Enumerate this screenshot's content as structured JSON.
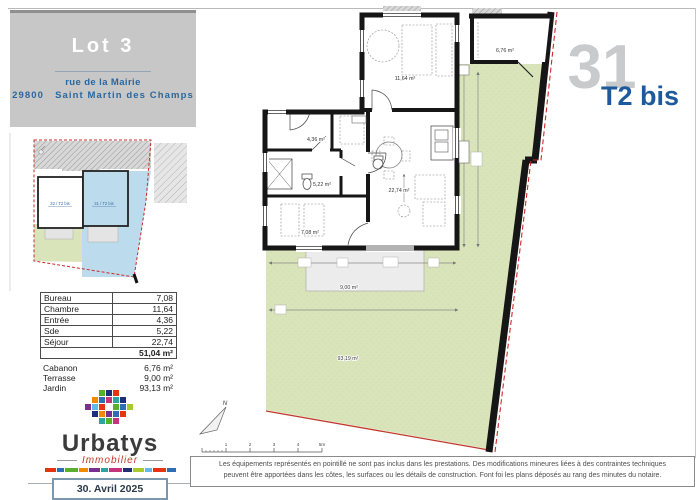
{
  "header": {
    "lot_title": "Lot 3",
    "street": "rue de la Mairie",
    "postal_code": "29800",
    "city": "Saint Martin des Champs"
  },
  "unit_badge": {
    "number": "31",
    "type": "T2 bis"
  },
  "site_plan": {
    "left_unit_label": "32 / T2 bis",
    "right_unit_label": "31 / T2 bis"
  },
  "areas": {
    "rows": [
      {
        "label": "Bureau",
        "value": "7,08"
      },
      {
        "label": "Chambre",
        "value": "11,64"
      },
      {
        "label": "Entrée",
        "value": "4,36"
      },
      {
        "label": "Sde",
        "value": "5,22"
      },
      {
        "label": "Séjour",
        "value": "22,74"
      }
    ],
    "total": "51,04 m²",
    "annex": [
      {
        "label": "Cabanon",
        "value": "6,76 m²"
      },
      {
        "label": "Terrasse",
        "value": "9,00 m²"
      },
      {
        "label": "Jardin",
        "value": "93,13 m²"
      }
    ]
  },
  "logo": {
    "name": "Urbatys",
    "subtitle": "Immobilier",
    "date": "30. Avril 2025",
    "mosaic": [
      {
        "x": 14,
        "y": 0,
        "c": "#5aaf2b"
      },
      {
        "x": 21,
        "y": 0,
        "c": "#1d2f7b"
      },
      {
        "x": 28,
        "y": 0,
        "c": "#e63312"
      },
      {
        "x": 7,
        "y": 7,
        "c": "#f18a00"
      },
      {
        "x": 14,
        "y": 7,
        "c": "#2f6db4"
      },
      {
        "x": 21,
        "y": 7,
        "c": "#c5357e"
      },
      {
        "x": 28,
        "y": 7,
        "c": "#2aa5a0"
      },
      {
        "x": 35,
        "y": 7,
        "c": "#1d2f7b"
      },
      {
        "x": 0,
        "y": 14,
        "c": "#7a2e8e"
      },
      {
        "x": 7,
        "y": 14,
        "c": "#64b9e4"
      },
      {
        "x": 14,
        "y": 14,
        "c": "#e63312"
      },
      {
        "x": 28,
        "y": 14,
        "c": "#5aaf2b"
      },
      {
        "x": 35,
        "y": 14,
        "c": "#2f6db4"
      },
      {
        "x": 42,
        "y": 14,
        "c": "#a8c92d"
      },
      {
        "x": 7,
        "y": 21,
        "c": "#1d2f7b"
      },
      {
        "x": 14,
        "y": 21,
        "c": "#f18a00"
      },
      {
        "x": 21,
        "y": 21,
        "c": "#7a2e8e"
      },
      {
        "x": 28,
        "y": 21,
        "c": "#2f6db4"
      },
      {
        "x": 35,
        "y": 21,
        "c": "#e63312"
      },
      {
        "x": 14,
        "y": 28,
        "c": "#2aa5a0"
      },
      {
        "x": 21,
        "y": 28,
        "c": "#5aaf2b"
      },
      {
        "x": 28,
        "y": 28,
        "c": "#c5357e"
      }
    ],
    "strip_colors": [
      "#e63312",
      "#2f6db4",
      "#5aaf2b",
      "#f18a00",
      "#7a2e8e",
      "#2aa5a0",
      "#c5357e",
      "#1d2f7b",
      "#a8c92d",
      "#64b9e4",
      "#e63312",
      "#2f6db4"
    ]
  },
  "plan": {
    "rooms": {
      "chambre": "11,64 m²",
      "cabanon": "6,76 m²",
      "entree": "4,36 m²",
      "sde": "5,22 m²",
      "sejour": "22,74 m²",
      "bureau": "7,08 m²",
      "terrasse": "9,00 m²",
      "jardin": "93,19 m²"
    },
    "compass_label": "N",
    "scale_labels": [
      "1",
      "2",
      "3",
      "4",
      "5m"
    ]
  },
  "disclaimer": {
    "line1": "Les équipements représentés en pointillé ne sont pas inclus dans les prestations. Des modifications mineures liées à des contraintes techniques",
    "line2": "peuvent être apportées dans les côtes, les surfaces ou les détails de construction. Font foi les plans déposés au rang des minutes du notaire."
  },
  "colors": {
    "accent_blue": "#1c5a9c",
    "address_blue": "#2a679f",
    "header_gray": "#c7c7c7",
    "unit_number_gray": "#c8cacc",
    "garden_green": "#d9e4ba",
    "site_plan_blue": "#bcdced",
    "boundary_red": "#c0392b",
    "wall_black": "#161616",
    "logo_red": "#c0392b"
  }
}
